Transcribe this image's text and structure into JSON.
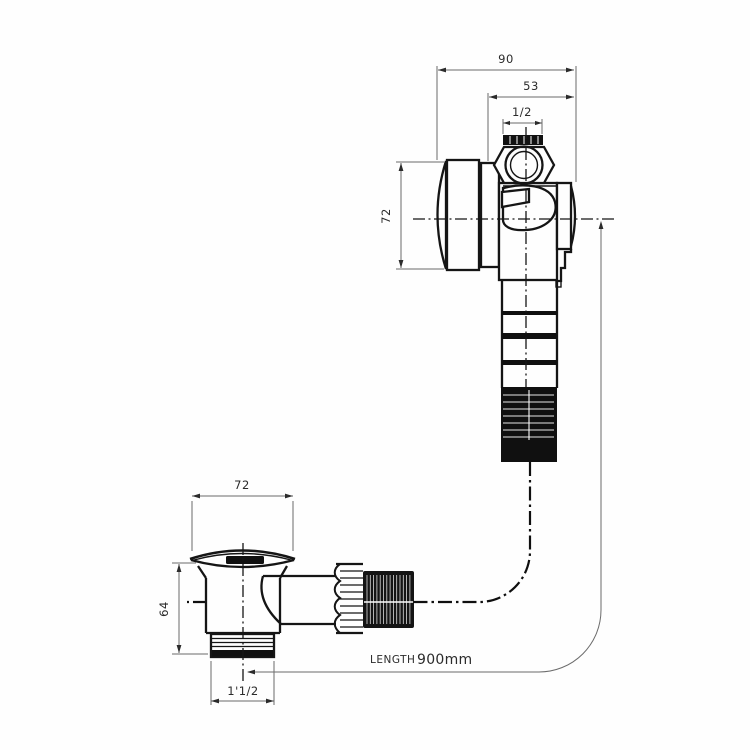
{
  "colors": {
    "ink": "#151515",
    "dimension": "#6b6b6b",
    "background": "#fefefe"
  },
  "dimensions": {
    "valve_overall_width": "90",
    "valve_body_width": "53",
    "inlet_size": "1/2",
    "valve_height": "72",
    "plug_cap_width": "72",
    "waste_height": "64",
    "waste_outlet_thread": "1'1/2"
  },
  "hose": {
    "label": "LENGTH",
    "value": "900mm"
  }
}
